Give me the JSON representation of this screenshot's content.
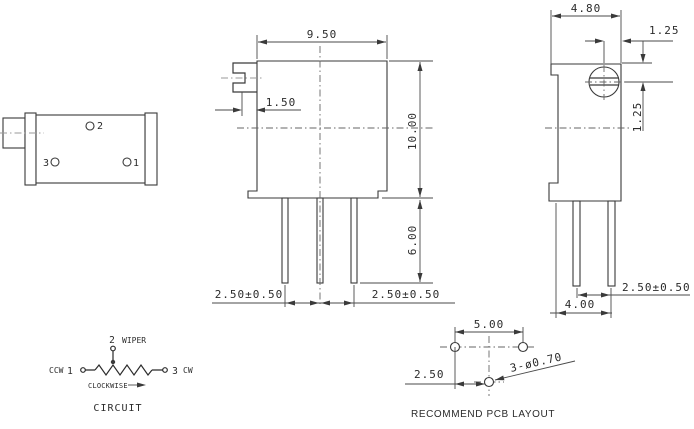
{
  "side_view_left": {
    "pin2": "2",
    "pin3": "3",
    "pin1": "1"
  },
  "front_view": {
    "width": "9.50",
    "shaft_protrusion": "1.50",
    "height": "10.00",
    "pin_length": "6.00",
    "pin_pitch_left": "2.50±0.50",
    "pin_pitch_right": "2.50±0.50"
  },
  "side_view_right": {
    "width": "4.80",
    "screw_offset_horizontal": "1.25",
    "screw_offset_vertical": "1.25",
    "pin_pitch": "2.50±0.50",
    "pin_row_span": "4.00"
  },
  "circuit": {
    "pin2": "2",
    "wiper": "WIPER",
    "ccw": "CCW",
    "pin1": "1",
    "pin3": "3",
    "cw": "CW",
    "clockwise": "CLOCKWISE",
    "caption": "CIRCUIT"
  },
  "pcb_layout": {
    "hole_spacing": "5.00",
    "row_offset": "2.50",
    "hole_diameter": "3-ø0.70",
    "caption": "RECOMMEND PCB LAYOUT"
  },
  "colors": {
    "line": "#3a3a3a",
    "centerline": "#666666",
    "centerline_light": "#9a9a9a",
    "background": "#ffffff"
  }
}
